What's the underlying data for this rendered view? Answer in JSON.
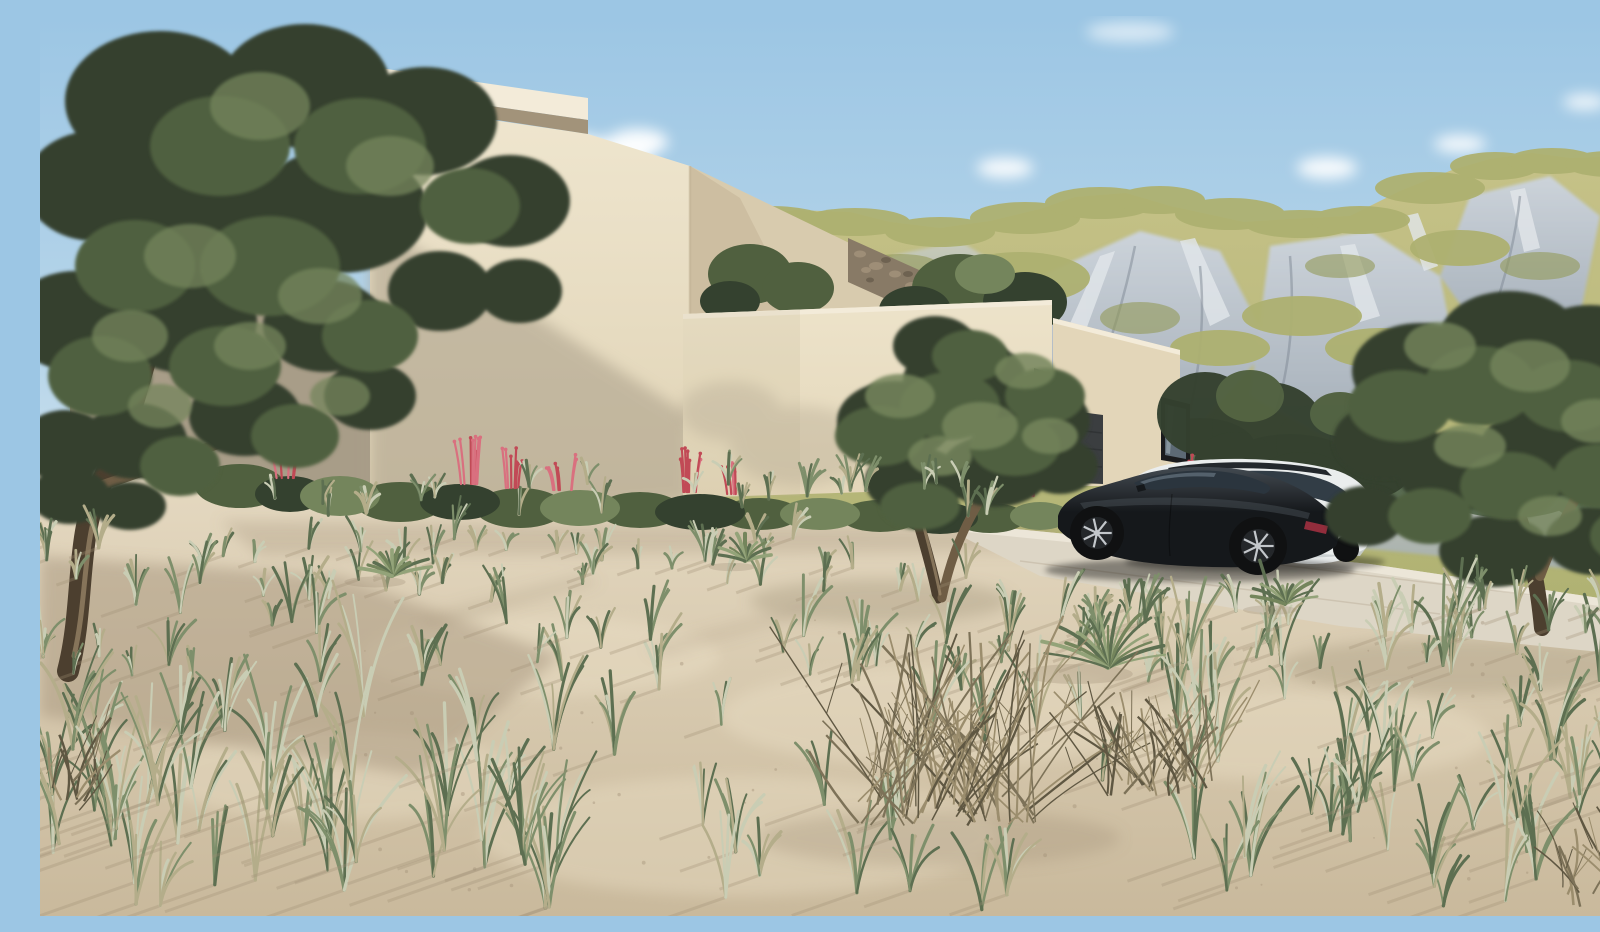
{
  "scene": {
    "description": "3D architectural rendering of a modern flat-roofed beige villa on a sandy desert plot with olive trees, dry grasses, a rocky green mountain range behind, and a dark sports coupe and white estate car parked on a concrete driveway.",
    "objects": [
      "sky",
      "clouds",
      "mountain-range",
      "modern-villa",
      "parapet-cap",
      "stone-wall",
      "garage-door",
      "window",
      "driveway",
      "black-sports-coupe",
      "white-estate-car",
      "olive-tree-left",
      "olive-tree-center",
      "olive-tree-right",
      "flowering-shrub-row",
      "dry-bush",
      "yucca-plants",
      "grass-tufts",
      "sand-ground"
    ]
  },
  "colors": {
    "sky_top": "#9cc6e4",
    "sky_mid": "#b8d6ea",
    "sky_horizon": "#dce9f0",
    "cloud": "#ffffff",
    "mtn_grass_light": "#c6c288",
    "mtn_grass": "#adb070",
    "mtn_grass_dark": "#939a58",
    "rock_light": "#ccd3da",
    "rock_mid": "#a3adb7",
    "rock_dark": "#7e8893",
    "rock_white": "#e2e6ea",
    "mtn_veg_dark": "#55684c",
    "wall_lit_top": "#efe6cf",
    "wall_lit_bottom": "#dfd2b4",
    "wall_bright_top": "#ede3ca",
    "wall_bright_bottom": "#e3d6b9",
    "wall_mid": "#d8cbae",
    "wall_shade": "#c4b598",
    "wall_shadowed": "#a89d88",
    "cap_light": "#f3ebd9",
    "cap_under": "#a2937a",
    "stone_wall": "#887a66",
    "stone_light": "#a4937c",
    "stone_dark": "#645949",
    "garage_door": "#3b3e40",
    "garage_line": "#2e3133",
    "recess_dark": "#45423b",
    "window_frame": "#1a1b1d",
    "glass": "#5d6a75",
    "glass_light": "#aebbc4",
    "driveway": "#ddd6c6",
    "driveway_edge": "#ece6d8",
    "sand_top": "#e5d9c1",
    "sand_bottom": "#c9b99c",
    "sand_light": "#f0e5cc",
    "sand_shadow": "#9f8f76",
    "foliage_dark": "#34412f",
    "foliage_mid": "#50603f",
    "foliage_light": "#74855c",
    "foliage_pale": "#93a379",
    "trunk": "#6f5d45",
    "trunk_dark": "#4c3f2f",
    "trunk_light": "#a08c6c",
    "grass_green": "#7e8f6b",
    "grass_pale": "#c9cdb4",
    "grass_dry": "#b4ad8a",
    "grass_deep": "#5d6f51",
    "bush_dark": "#5f5742",
    "bush_mid": "#7d7258",
    "bush_light": "#9b8d6d",
    "flower_pink": "#d9707f",
    "flower_red": "#c14a56",
    "car_black_hi": "#434a51",
    "car_black": "#15181b",
    "car_glass": "#2b353e",
    "car_glass_hi": "#93a6b2",
    "rim": "#c3c7cb",
    "tire": "#101112",
    "tail_red": "#a03040",
    "suv_white": "#eaeded",
    "suv_shade": "#c6cccd",
    "suv_glass": "#323d46",
    "suv_trim": "#23282c",
    "shadow": "#000000"
  },
  "vegetation": {
    "seed": 13,
    "grass_bands": [
      {
        "x0": 190,
        "x1": 1010,
        "y0": 462,
        "y1": 500,
        "count": 24,
        "hMin": 18,
        "hMax": 36,
        "shadow": false
      },
      {
        "x0": 0,
        "x1": 940,
        "y0": 520,
        "y1": 585,
        "count": 44,
        "hMin": 18,
        "hMax": 40,
        "shadow": true
      },
      {
        "x0": 0,
        "x1": 1600,
        "y0": 585,
        "y1": 675,
        "count": 55,
        "hMin": 26,
        "hMax": 58,
        "shadow": true
      },
      {
        "x0": 0,
        "x1": 540,
        "y0": 675,
        "y1": 895,
        "count": 48,
        "hMin": 55,
        "hMax": 125,
        "shadow": true
      },
      {
        "x0": 540,
        "x1": 1120,
        "y0": 700,
        "y1": 895,
        "count": 20,
        "hMin": 40,
        "hMax": 85,
        "shadow": true
      },
      {
        "x0": 1120,
        "x1": 1600,
        "y0": 640,
        "y1": 895,
        "count": 50,
        "hMin": 45,
        "hMax": 105,
        "shadow": true
      },
      {
        "x0": 950,
        "x1": 1600,
        "y0": 592,
        "y1": 648,
        "count": 24,
        "hMin": 22,
        "hMax": 48,
        "shadow": true
      }
    ],
    "twig_clusters": [
      {
        "x": 905,
        "y": 795,
        "n": 70,
        "spread": 260,
        "hMin": 70,
        "hMax": 185
      },
      {
        "x": 1120,
        "y": 765,
        "n": 30,
        "spread": 150,
        "hMin": 40,
        "hMax": 105
      },
      {
        "x": 1560,
        "y": 880,
        "n": 16,
        "spread": 120,
        "hMin": 35,
        "hMax": 85
      },
      {
        "x": 15,
        "y": 780,
        "n": 14,
        "spread": 90,
        "hMin": 35,
        "hMax": 80
      }
    ],
    "yuccas": [
      {
        "x": 1068,
        "y": 652,
        "r": 62,
        "n": 17
      },
      {
        "x": 352,
        "y": 560,
        "r": 34,
        "n": 13
      },
      {
        "x": 705,
        "y": 545,
        "r": 26,
        "n": 11
      },
      {
        "x": 1245,
        "y": 588,
        "r": 30,
        "n": 12
      }
    ],
    "flower_clusters": [
      {
        "x": 432,
        "y": 468,
        "h": 40,
        "n": 8
      },
      {
        "x": 472,
        "y": 472,
        "h": 34,
        "n": 7
      },
      {
        "x": 524,
        "y": 474,
        "h": 30,
        "n": 6
      },
      {
        "x": 648,
        "y": 476,
        "h": 38,
        "n": 8
      },
      {
        "x": 697,
        "y": 478,
        "h": 30,
        "n": 6
      },
      {
        "x": 948,
        "y": 478,
        "h": 34,
        "n": 7
      },
      {
        "x": 990,
        "y": 480,
        "h": 28,
        "n": 6
      },
      {
        "x": 1148,
        "y": 470,
        "h": 26,
        "n": 5
      },
      {
        "x": 246,
        "y": 462,
        "h": 26,
        "n": 5
      }
    ],
    "pebbles": {
      "x0": 260,
      "x1": 1500,
      "y0": 600,
      "y1": 885,
      "count": 70
    }
  }
}
